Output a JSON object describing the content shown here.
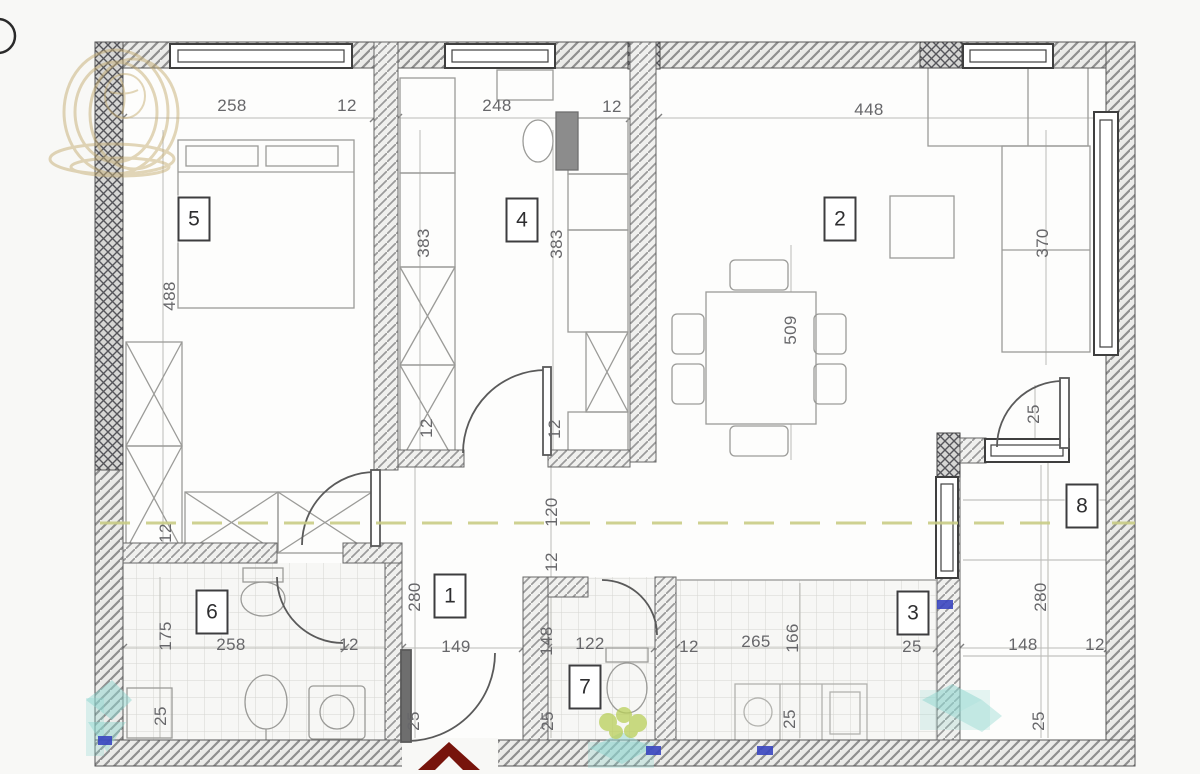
{
  "plan": {
    "title": "apartment-floor-plan",
    "room_labels": [
      {
        "number": "5",
        "x": 194,
        "y": 219
      },
      {
        "number": "4",
        "x": 522,
        "y": 220
      },
      {
        "number": "2",
        "x": 840,
        "y": 219
      },
      {
        "number": "1",
        "x": 450,
        "y": 596
      },
      {
        "number": "6",
        "x": 212,
        "y": 612
      },
      {
        "number": "7",
        "x": 585,
        "y": 687
      },
      {
        "number": "3",
        "x": 913,
        "y": 613
      },
      {
        "number": "8",
        "x": 1082,
        "y": 506
      }
    ],
    "dimension_labels": [
      {
        "text": "258",
        "x": 232,
        "y": 106,
        "rot": 0
      },
      {
        "text": "12",
        "x": 347,
        "y": 106,
        "rot": 0
      },
      {
        "text": "248",
        "x": 497,
        "y": 106,
        "rot": 0
      },
      {
        "text": "12",
        "x": 612,
        "y": 107,
        "rot": 0
      },
      {
        "text": "448",
        "x": 869,
        "y": 110,
        "rot": 0
      },
      {
        "text": "488",
        "x": 170,
        "y": 296,
        "rot": 1
      },
      {
        "text": "383",
        "x": 424,
        "y": 243,
        "rot": 1
      },
      {
        "text": "383",
        "x": 557,
        "y": 244,
        "rot": 1
      },
      {
        "text": "370",
        "x": 1043,
        "y": 243,
        "rot": 1
      },
      {
        "text": "509",
        "x": 791,
        "y": 330,
        "rot": 1
      },
      {
        "text": "12",
        "x": 427,
        "y": 428,
        "rot": 1
      },
      {
        "text": "12",
        "x": 555,
        "y": 429,
        "rot": 1
      },
      {
        "text": "25",
        "x": 1034,
        "y": 414,
        "rot": 1
      },
      {
        "text": "120",
        "x": 552,
        "y": 512,
        "rot": 1
      },
      {
        "text": "12",
        "x": 552,
        "y": 562,
        "rot": 1
      },
      {
        "text": "12",
        "x": 166,
        "y": 533,
        "rot": 1
      },
      {
        "text": "280",
        "x": 415,
        "y": 597,
        "rot": 1
      },
      {
        "text": "280",
        "x": 1041,
        "y": 597,
        "rot": 1
      },
      {
        "text": "175",
        "x": 166,
        "y": 636,
        "rot": 1
      },
      {
        "text": "258",
        "x": 231,
        "y": 645,
        "rot": 0
      },
      {
        "text": "12",
        "x": 349,
        "y": 645,
        "rot": 0
      },
      {
        "text": "149",
        "x": 456,
        "y": 647,
        "rot": 0
      },
      {
        "text": "148",
        "x": 547,
        "y": 641,
        "rot": 1
      },
      {
        "text": "122",
        "x": 590,
        "y": 644,
        "rot": 0
      },
      {
        "text": "12",
        "x": 689,
        "y": 647,
        "rot": 0
      },
      {
        "text": "265",
        "x": 756,
        "y": 642,
        "rot": 0
      },
      {
        "text": "166",
        "x": 793,
        "y": 638,
        "rot": 1
      },
      {
        "text": "25",
        "x": 912,
        "y": 647,
        "rot": 0
      },
      {
        "text": "148",
        "x": 1023,
        "y": 645,
        "rot": 0
      },
      {
        "text": "12",
        "x": 1095,
        "y": 645,
        "rot": 0
      },
      {
        "text": "25",
        "x": 161,
        "y": 716,
        "rot": 1
      },
      {
        "text": "25",
        "x": 414,
        "y": 721,
        "rot": 1
      },
      {
        "text": "25",
        "x": 548,
        "y": 721,
        "rot": 1
      },
      {
        "text": "25",
        "x": 790,
        "y": 719,
        "rot": 1
      },
      {
        "text": "25",
        "x": 1039,
        "y": 721,
        "rot": 1
      }
    ],
    "colors": {
      "watermark_gold": "#c6ae74",
      "watermark_teal": "#8fd6cf",
      "watermark_yellow_green": "#b9cf5a",
      "entrance_arrow_red": "#77140c",
      "section_line_olive": "#c9cd86",
      "marker_blue": "#3a46c0",
      "wall_dark": "#4f4f52",
      "line_gray": "#9b9b98"
    }
  }
}
